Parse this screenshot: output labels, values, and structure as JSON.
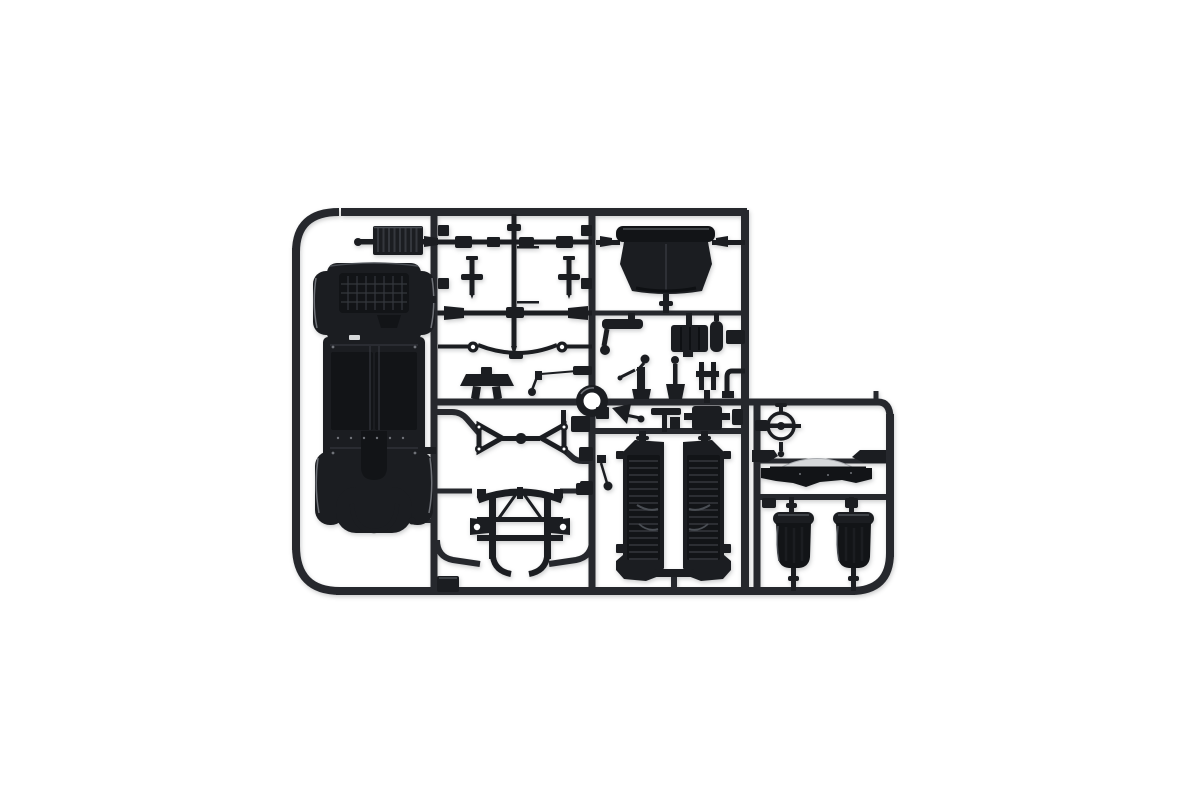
{
  "scene": {
    "type": "product-photo",
    "subject": "model-kit-sprue",
    "description": "Injection-moulded dark grey plastic sprue (parts tree) of a vintage car model kit photographed on a plain white background",
    "background": "#ffffff"
  },
  "colors": {
    "css_vars": "--bg:#ffffff;--runner:#26282d;--dark:#1b1d21;--deep:#121417;--mid:#34373d;--soft:#4a4e54;--hi:#6f7278;--glint:#d6d8da",
    "background": "#ffffff",
    "sprue_runner": "#26282d",
    "plastic_dark": "#1b1d21",
    "plastic_deep": "#121417",
    "panel_line": "#34373d",
    "soft_highlight": "#4a4e54",
    "edge_highlight": "#6f7278",
    "glint": "#d6d8da"
  },
  "sprue": {
    "parts": [
      {
        "name": "chassis-floor-pan",
        "count": 1
      },
      {
        "name": "radiator-grille",
        "count": 1
      },
      {
        "name": "front-axle",
        "count": 1
      },
      {
        "name": "rear-axle",
        "count": 1
      },
      {
        "name": "steering-column-rod",
        "count": 1
      },
      {
        "name": "kingpin",
        "count": 2
      },
      {
        "name": "leaf-spring",
        "count": 1
      },
      {
        "name": "pedal-board",
        "count": 1
      },
      {
        "name": "linkage-lever",
        "count": 1
      },
      {
        "name": "cowl-panel",
        "count": 1
      },
      {
        "name": "crank-lever",
        "count": 1
      },
      {
        "name": "gearbox",
        "count": 1
      },
      {
        "name": "cylinder-part",
        "count": 1
      },
      {
        "name": "gear-lever",
        "count": 2
      },
      {
        "name": "prong-bracket",
        "count": 1
      },
      {
        "name": "elbow-bracket",
        "count": 1
      },
      {
        "name": "horn-funnel",
        "count": 1
      },
      {
        "name": "tee-fitting",
        "count": 1
      },
      {
        "name": "junction-box",
        "count": 1
      },
      {
        "name": "tyre-ring",
        "count": 1
      },
      {
        "name": "wishbone",
        "count": 2
      },
      {
        "name": "bulkhead-frame",
        "count": 1
      },
      {
        "name": "louvred-bonnet-side-panel",
        "count": 2
      },
      {
        "name": "steering-wheel",
        "count": 1
      },
      {
        "name": "dashboard-cowl",
        "count": 1
      },
      {
        "name": "bucket-seat",
        "count": 2
      }
    ]
  }
}
